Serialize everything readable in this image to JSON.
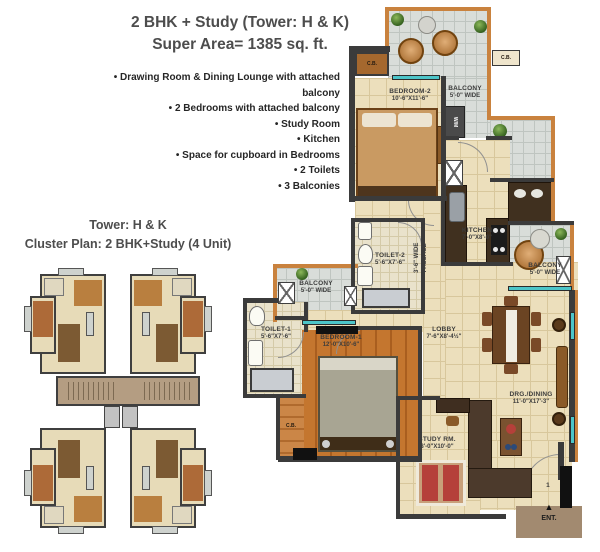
{
  "header": {
    "title_line1": "2 BHK + Study (Tower: H & K)",
    "title_line2": "Super Area= 1385 sq. ft."
  },
  "features": [
    "• Drawing Room & Dining Lounge with attached balcony",
    "• 2 Bedrooms with attached balcony",
    "• Study Room",
    "• Kitchen",
    "• Space for cupboard in Bedrooms",
    "• 2 Toilets",
    "• 3 Balconies"
  ],
  "cluster": {
    "title_line1": "Tower: H & K",
    "title_line2": "Cluster Plan: 2 BHK+Study (4 Unit)"
  },
  "plan": {
    "bedroom2": {
      "name": "BEDROOM-2",
      "dim": "10'-6\"X11'-6\""
    },
    "balcony_top": {
      "name": "BALCONY",
      "dim": "5'-0\" WIDE"
    },
    "balcony_right": {
      "name": "BALCONY",
      "dim": "5'-0\" WIDE"
    },
    "balcony_left": {
      "name": "BALCONY",
      "dim": "5'-0\" WIDE"
    },
    "kitchen": {
      "name": "KITCHEN",
      "dim": "7'-0\"X8'-0\""
    },
    "toilet2": {
      "name": "TOILET-2",
      "dim": "5'-6\"X7'-6\""
    },
    "toilet1": {
      "name": "TOILET-1",
      "dim": "5'-6\"X7'-6\""
    },
    "passage": {
      "line1": "3'-6\" WIDE",
      "line2": "PASSAGE"
    },
    "bedroom1": {
      "name": "BEDROOM-1",
      "dim": "12'-0\"X10'-6\""
    },
    "lobby": {
      "name": "LOBBY",
      "dim": "7'-6\"X8'-4½\""
    },
    "drg_dining": {
      "name": "DRG./DINING",
      "dim": "11'-0\"X17'-3\""
    },
    "study": {
      "name": "STUDY RM.",
      "dim": "8'-0\"X10'-0\""
    },
    "labels": {
      "cb": "C.B.",
      "wm": "W/M",
      "ent": "ENT.",
      "unit_number": "1",
      "arrow": "▲"
    }
  },
  "colors": {
    "accent_orange": "#c9823e",
    "wall": "#3b3b3b",
    "floor_beige": "#ecdfbc",
    "wood": "#c4762f",
    "balcony_tile": "#d9ddd9",
    "teal_window": "#4cc5c9"
  }
}
